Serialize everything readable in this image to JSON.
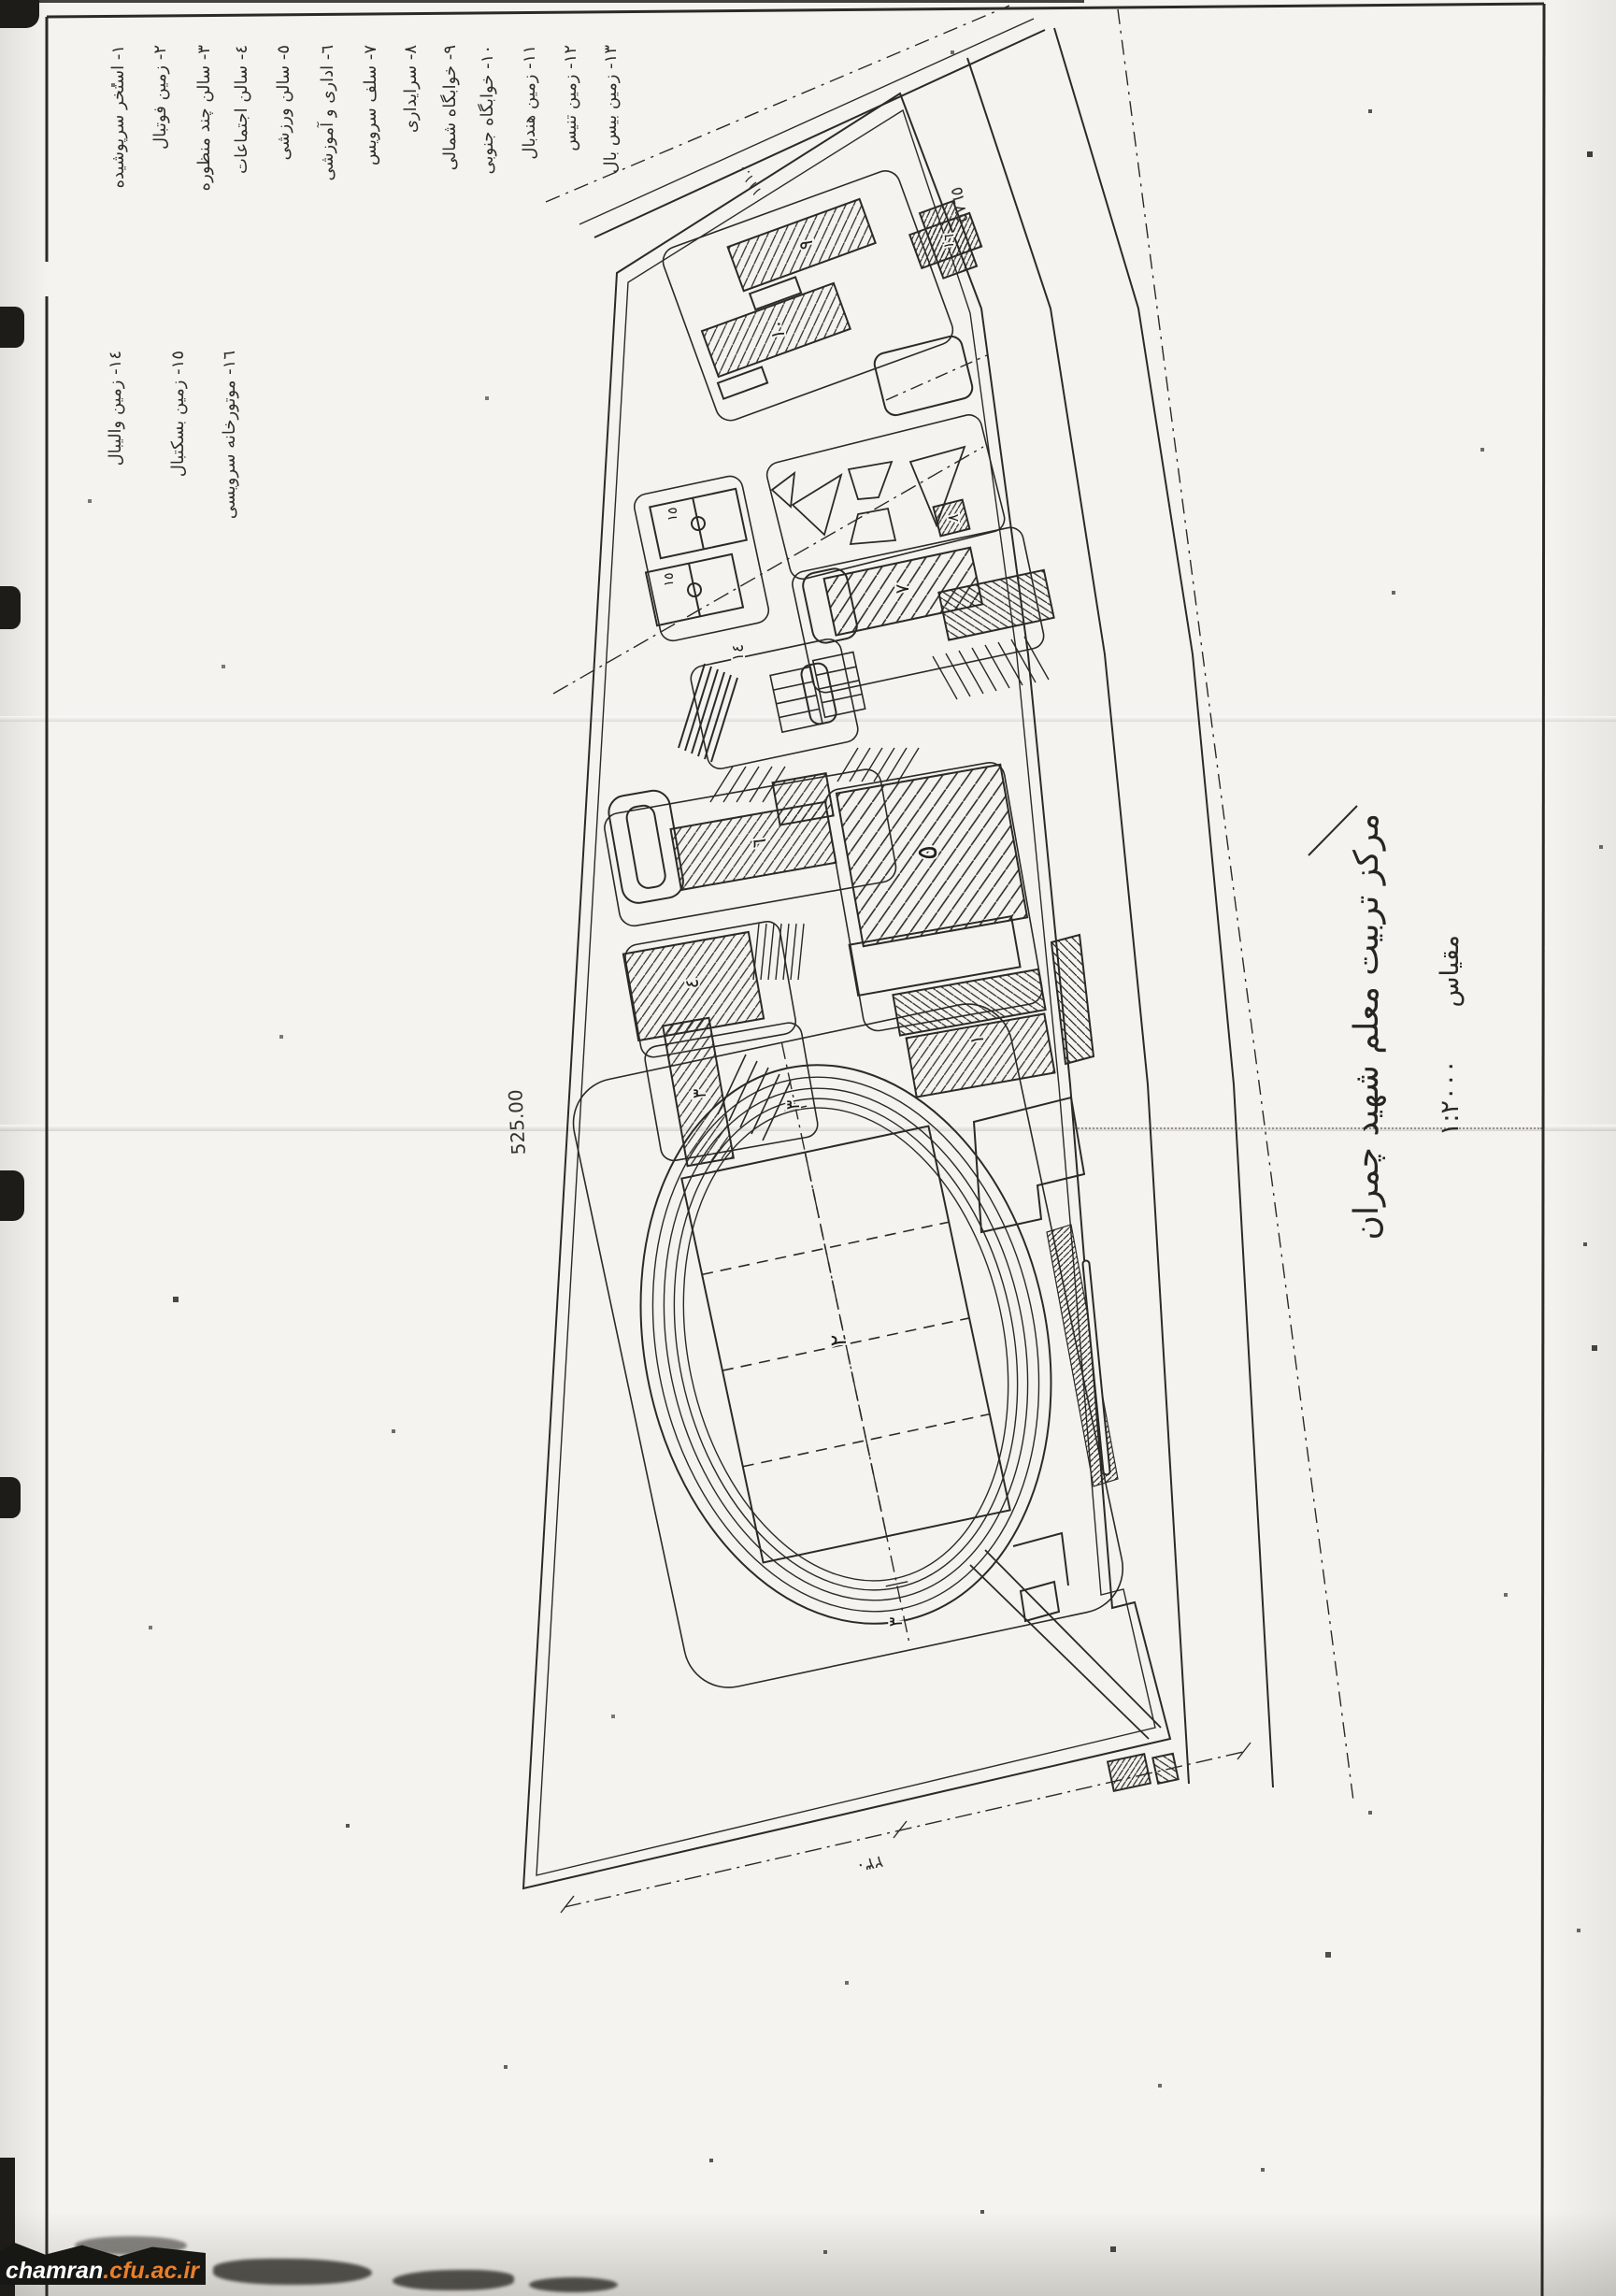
{
  "colors": {
    "paper": "#f4f3ef",
    "ink": "#2b2a27",
    "watermark_site_color": "#ffffff",
    "watermark_domain_color": "#e87f2a"
  },
  "legend": {
    "column1": [
      {
        "num": "١",
        "label": "استخر سرپوشیده",
        "text": "١- استخر سرپوشیده"
      },
      {
        "num": "٢",
        "label": "زمین فوتبال",
        "text": "٢- زمین فوتبال"
      },
      {
        "num": "٣",
        "label": "سالن چند منظوره",
        "text": "٣- سالن چند منظوره"
      },
      {
        "num": "٤",
        "label": "سالن اجتماعات",
        "text": "٤- سالن اجتماعات"
      },
      {
        "num": "٥",
        "label": "سالن ورزشی",
        "text": "٥- سالن ورزشی"
      },
      {
        "num": "٦",
        "label": "اداری و آموزشی",
        "text": "٦- اداری و آموزشی"
      },
      {
        "num": "٧",
        "label": "سلف سرویس",
        "text": "٧- سلف سرویس"
      },
      {
        "num": "٨",
        "label": "سرایداری",
        "text": "٨- سرایداری"
      },
      {
        "num": "٩",
        "label": "خوابگاه شمالی",
        "text": "٩- خوابگاه شمالی"
      },
      {
        "num": "١٠",
        "label": "خوابگاه جنوبی",
        "text": "١٠- خوابگاه جنوبی"
      },
      {
        "num": "١١",
        "label": "زمین هندبال",
        "text": "١١- زمین هندبال"
      },
      {
        "num": "١٢",
        "label": "زمین تنیس",
        "text": "١٢- زمین تنیس"
      },
      {
        "num": "١٣",
        "label": "زمین بیس بال",
        "text": "١٣- زمین بیس بال"
      }
    ],
    "column2": [
      {
        "num": "١٤",
        "label": "زمین والیبال",
        "text": "١٤- زمین والیبال"
      },
      {
        "num": "١٥",
        "label": "زمین بسکتبال",
        "text": "١٥- زمین بسکتبال"
      },
      {
        "num": "١٦",
        "label": "موتورخانه سرویسی",
        "text": "١٦- موتورخانه سرویسی"
      }
    ]
  },
  "title_block": {
    "title": "مرکز تربیت معلم شهید چمران",
    "scale_label": "مقیاس",
    "scale_value": "١:٢٠٠٠"
  },
  "plan": {
    "building_labels": {
      "b1": "١",
      "b3": "٣",
      "b4": "٤",
      "b5": "٥",
      "b6": "٦",
      "b7": "٧",
      "b8": "٨",
      "b9": "٩",
      "b10": "١٠",
      "b16": "١٦"
    },
    "court_labels": {
      "c14": "١٤",
      "c15a": "١٥",
      "c15b": "١٥"
    },
    "field_label": "٢",
    "axis_label_top": "٣",
    "axis_label_bottom": "٣",
    "dimensions": {
      "west_boundary": "525.00",
      "south_boundary": "٢٣٠",
      "east_road": "٥٧٦٥",
      "northwest_edge": "١١١.٠"
    }
  },
  "watermark": {
    "site": "chamran",
    "domain": ".cfu.ac.ir"
  }
}
